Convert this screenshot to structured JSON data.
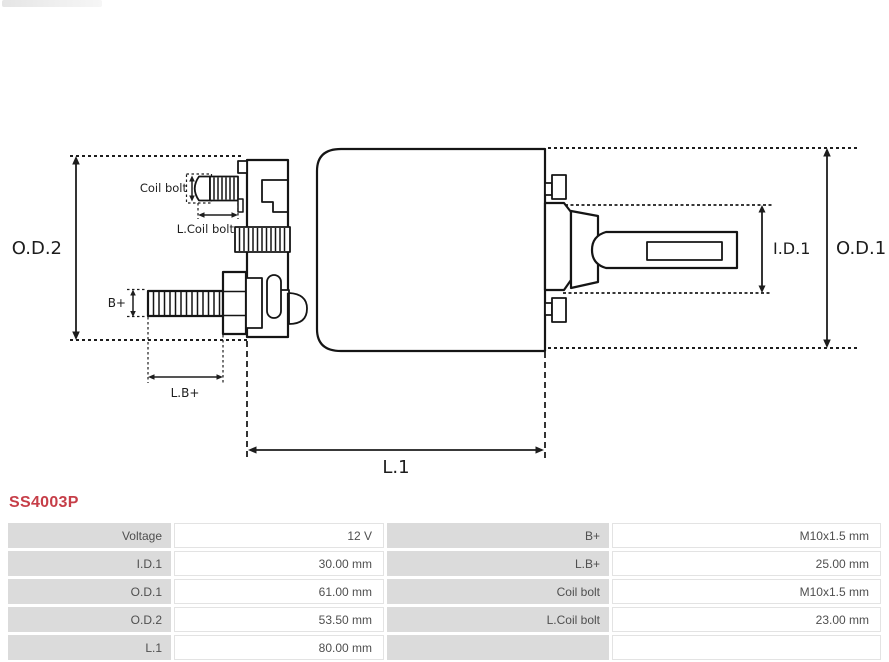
{
  "part_number": "SS4003P",
  "colors": {
    "part_number_red": "#c63e48",
    "diagram_line": "#151515",
    "table_label_bg": "#dbdbdb",
    "table_value_border": "#e3e3e3",
    "table_text": "#4f4f4f"
  },
  "diagram": {
    "labels": {
      "od2": "O.D.2",
      "od1": "O.D.1",
      "id1": "I.D.1",
      "l1": "L.1",
      "b_plus": "B+",
      "l_b_plus": "L.B+",
      "coil_bolt": "Coil bolt",
      "l_coil_bolt": "L.Coil bolt"
    }
  },
  "spec_table": {
    "left_rows": [
      {
        "label": "Voltage",
        "value": "12 V"
      },
      {
        "label": "I.D.1",
        "value": "30.00 mm"
      },
      {
        "label": "O.D.1",
        "value": "61.00 mm"
      },
      {
        "label": "O.D.2",
        "value": "53.50 mm"
      },
      {
        "label": "L.1",
        "value": "80.00 mm"
      }
    ],
    "right_rows": [
      {
        "label": "B+",
        "value": "M10x1.5 mm"
      },
      {
        "label": "L.B+",
        "value": "25.00 mm"
      },
      {
        "label": "Coil bolt",
        "value": "M10x1.5 mm"
      },
      {
        "label": "L.Coil bolt",
        "value": "23.00 mm"
      },
      {
        "label": "",
        "value": ""
      }
    ]
  }
}
